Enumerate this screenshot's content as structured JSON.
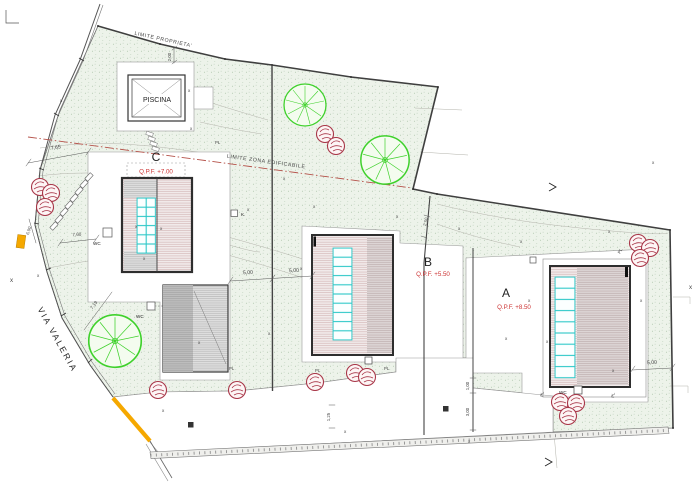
{
  "plan": {
    "street_label": "VIA VALERIA",
    "boundaries": {
      "property_limit": "LIMITE PROPRIETA'",
      "buildable_limit": "LIMITE ZONA EDIFICABILE"
    },
    "pool": {
      "label": "PISCINA"
    },
    "buildings": {
      "a": {
        "name": "A",
        "elevation": "Q.P.F. +8.50"
      },
      "b": {
        "name": "B",
        "elevation": "Q.P.F. +5.50"
      },
      "c": {
        "name": "C",
        "elevation": "Q.P.F. +7.00"
      }
    },
    "annotations": {
      "wc": "WC",
      "pl": "PL",
      "k": "K.",
      "marker": "x"
    },
    "dimensions": {
      "d765": "7,65",
      "d760": "7,60",
      "d719": "7,19",
      "d600": "6,00",
      "d500": "5,00",
      "d300": "3,00",
      "d250": "2,50",
      "d200": "2,00",
      "d125": "1,25",
      "d100": "1,00"
    },
    "colors": {
      "tree_green": "#3fd12c",
      "bush_red": "#a83648",
      "skylight_teal": "#2cc8c8",
      "gate_orange": "#f5a800",
      "elevation_red": "#cc3333",
      "buildable_line_red": "#b5524a",
      "terrain_green": "#edf3ea"
    }
  }
}
